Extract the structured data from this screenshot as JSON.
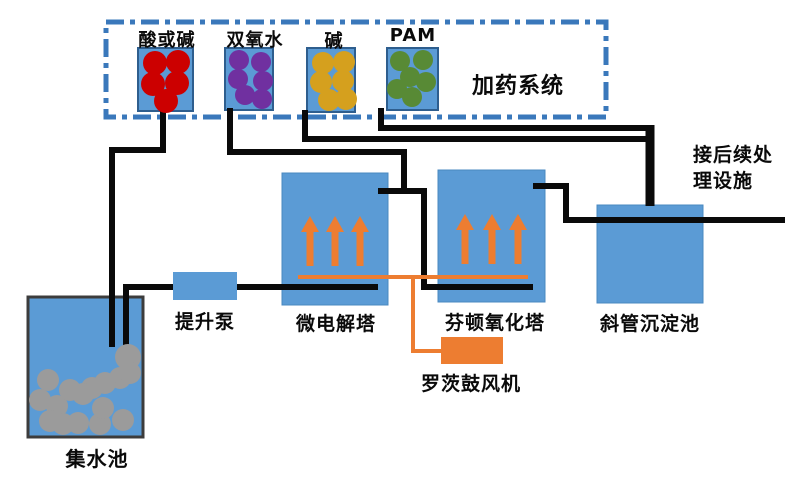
{
  "diagram": {
    "dosing_system": {
      "label": "加药系统",
      "tanks": [
        {
          "label": "酸或碱",
          "dot_color": "#CC0000"
        },
        {
          "label": "双氧水",
          "dot_color": "#7030A0"
        },
        {
          "label": "碱",
          "dot_color": "#D5A01E"
        },
        {
          "label": "PAM",
          "dot_color": "#588A35"
        }
      ]
    },
    "units": {
      "collection_tank": "集水池",
      "lift_pump": "提升泵",
      "micro_electrolysis_tower": "微电解塔",
      "fenton_oxidation_tower": "芬顿氧化塔",
      "inclined_tube_settler": "斜管沉淀池",
      "roots_blower": "罗茨鼓风机"
    },
    "notes": {
      "to_subsequent_treatment": "接后续处理设施"
    },
    "colors": {
      "tank_blue": "#5B9BD5",
      "tank_border": "#2E5E8E",
      "pipe_black": "#0A0A0A",
      "aeration_orange": "#ED7D31",
      "dashed_border_blue": "#3A78BB",
      "sludge_gray": "#9B9B9B"
    }
  }
}
